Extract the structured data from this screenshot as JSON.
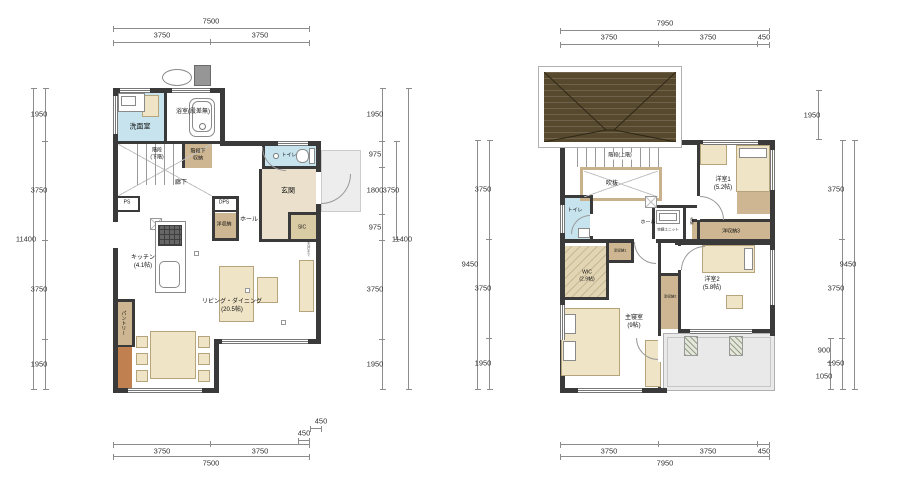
{
  "colors": {
    "wall": "#3a3a3a",
    "wet_room": "#c6e3ee",
    "storage": "#cdb691",
    "entry_floor": "#eae0cb",
    "wood": "#c08050",
    "furniture": "#efe4c6",
    "roof": "#57492e",
    "balcony": "#e9e9e9",
    "porch": "#ededed"
  },
  "f1": {
    "labels": {
      "washroom": "洗面室",
      "bath": "浴室(段差無)",
      "stairs": "階段\n(下階)",
      "under_stairs": "階段下\n収納",
      "hallway": "廊下",
      "ps": "PS",
      "dps": "DPS",
      "closet": "洋収納",
      "hall": "ホール",
      "sic": "SIC",
      "entry": "玄関",
      "toilet": "トイレ",
      "kitchen": "キッチン\n(4.1帖)",
      "living_dining": "リビング・ダイニング\n(20.5帖)",
      "pantry": "パントリー",
      "shelf": "天井まで"
    },
    "dims": {
      "top_total": "7500",
      "top_segs": [
        "3750",
        "3750"
      ],
      "right_of_bottom": [
        "450",
        "450"
      ],
      "bottom_segs": [
        "3750",
        "3750"
      ],
      "bottom_total": "7500",
      "left_total": "11400",
      "left_segs": [
        "1950",
        "3750",
        "3750",
        "1950"
      ],
      "right_segs": [
        "1950",
        "975",
        "1800",
        "975",
        "3750",
        "1950"
      ],
      "right_mid": "3750",
      "right_total": "11400"
    }
  },
  "f2": {
    "labels": {
      "stairs": "階段(上階)",
      "void": "吹抜",
      "toilet": "トイレ",
      "hall": "ホール",
      "aircon": "空調ユニット",
      "storage": "収納",
      "room1": "洋室1\n(5.2帖)",
      "closet3": "洋収納3",
      "closet1": "洋収納1",
      "wic": "WIC\n(2.9帖)",
      "closet2": "洋収納2",
      "room2": "洋室2\n(5.8帖)",
      "master": "主寝室\n(9帖)"
    },
    "dims": {
      "top_total": "7950",
      "top_segs": [
        "3750",
        "3750",
        "450"
      ],
      "bottom_segs": [
        "3750",
        "3750",
        "450"
      ],
      "bottom_total": "7950",
      "left_total": "9450",
      "left_segs": [
        "3750",
        "3750",
        "1950"
      ],
      "right_top": "1950",
      "right_inner": [
        "900",
        "1050"
      ],
      "right_segs": [
        "3750",
        "3750",
        "1950"
      ],
      "right_total": "9450"
    }
  }
}
